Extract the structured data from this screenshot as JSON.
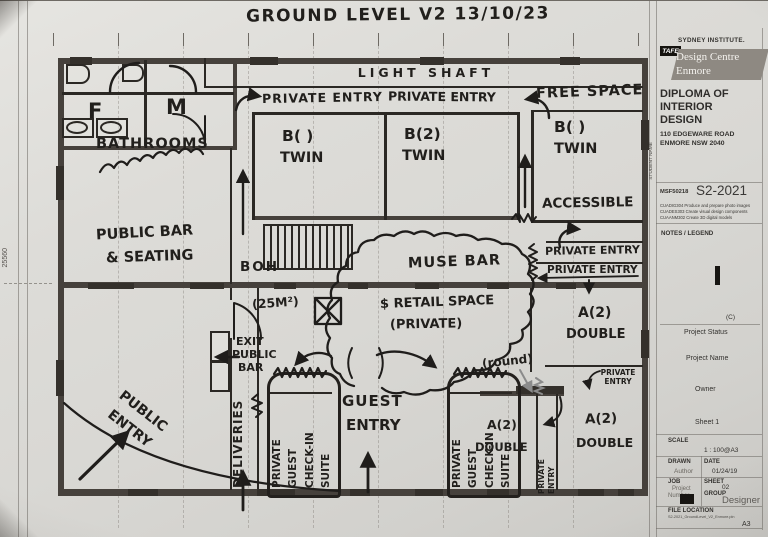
{
  "title": "GROUND LEVEL V2    13/10/23",
  "dim_left": "25560",
  "plan": {
    "light_shaft": "LIGHT SHAFT",
    "private_entry_top_left": "PRIVATE ENTRY",
    "private_entry_top_right": "PRIVATE ENTRY",
    "free_space": "FREE SPACE",
    "f": "F",
    "m": "M",
    "bathrooms": "BATHROOMS",
    "b1": "B( )",
    "b1_type": "TWIN",
    "b2": "B(2)",
    "b2_type": "TWIN",
    "b3": "B(  )",
    "b3_type": "TWIN",
    "accessible": "ACCESSIBLE",
    "public_bar_1": "PUBLIC BAR",
    "public_bar_2": "& SEATING",
    "boh": "BOH",
    "muse_bar": "MUSE BAR",
    "private_entry_mid_1": "PRIVATE ENTRY",
    "private_entry_mid_2": "PRIVATE ENTRY",
    "area25": "(25M²)",
    "retail_1": "$ RETAIL SPACE",
    "retail_2": "(PRIVATE)",
    "a2_ne": "A(2)",
    "a2_ne_type": "DOUBLE",
    "exit_1": "EXIT",
    "exit_2": "PUBLIC",
    "exit_3": "BAR",
    "round_note": "(round)",
    "private_entry_small": "PRIVATE\nENTRY",
    "guest_1": "GUEST",
    "guest_2": "ENTRY",
    "deliveries": "DELIVERIES",
    "public_entry": "PUBLIC\nENTRY",
    "suite_w1": "PRIVATE",
    "suite_w2": "GUEST",
    "suite_w3": "CHECK-IN",
    "suite_w4": "SUITE",
    "private_entry_corr_1": "PRIVATE",
    "private_entry_corr_2": "ENTRY",
    "a2_sw": "A(2)",
    "a2_sw_type": "DOUBLE",
    "a2_se": "A(2)",
    "a2_se_type": "DOUBLE"
  },
  "tb": {
    "institute": "SYDNEY INSTITUTE.",
    "tafe": "TAFE",
    "centre1": "Design Centre",
    "centre2": "Enmore",
    "course1": "DIPLOMA OF",
    "course2": "INTERIOR",
    "course3": "DESIGN",
    "addr1": "110 EDGEWARE ROAD",
    "addr2": "ENMORE NSW 2040",
    "student_name": "STUDENT NAME",
    "code": "MSF50218",
    "sem": "S2-2021",
    "unit1": "CUADIG304 Produce and prepare photo images",
    "unit2": "CUADES303 Create visual design components",
    "unit3": "CUAANM302 Create 3D digital models",
    "notes": "NOTES / LEGEND",
    "copy": "(C)",
    "project_status": "Project Status",
    "project_name": "Project Name",
    "owner": "Owner",
    "sheet1": "Sheet 1",
    "scale_label": "SCALE",
    "scale_value": "1 : 100@A3",
    "drawn": "DRAWN",
    "date": "DATE",
    "author": "Author",
    "date_value": "01/24/19",
    "job": "JOB",
    "sheet": "SHEET",
    "project": "Project",
    "number": "Number",
    "sheet_value": "02",
    "group": "GROUP",
    "group_value": "Designer",
    "file_location": "FILE LOCATION",
    "file_path": "S2-2021_GroundLevel_V2_Enmore.pln",
    "paper": "A3"
  }
}
